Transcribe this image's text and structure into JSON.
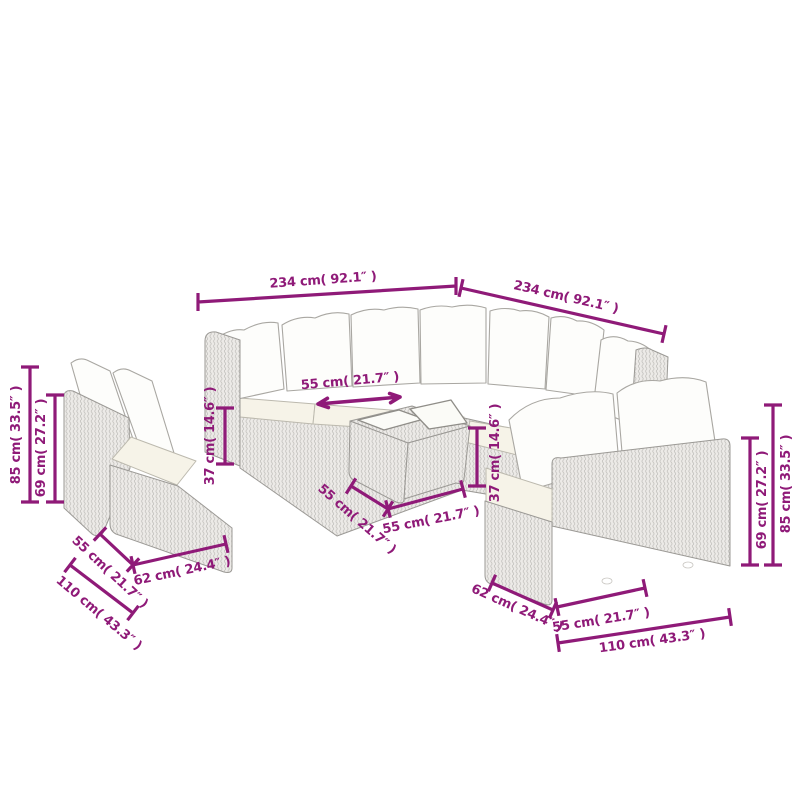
{
  "page": {
    "background": "#ffffff",
    "subject": "Modular poly-rattan garden lounge set (corner sofa, two 2-seater sofas, glass-top coffee table) shown as outline drawing with dimension lines"
  },
  "colors": {
    "dimension_line": "#8f1a78",
    "wicker_gray": "#e9e8e6",
    "cushion_white": "#fdfdfb",
    "seat_cream": "#f6f3e8"
  },
  "annotations": [
    {
      "id": "sofa-width-left",
      "label": "234 cm( 92.1″ )"
    },
    {
      "id": "sofa-width-right",
      "label": "234 cm( 92.1″ )"
    },
    {
      "id": "seat-width-top",
      "label": "55 cm( 21.7″ )"
    },
    {
      "id": "seat-height-left",
      "label": "37 cm( 14.6″ )"
    },
    {
      "id": "total-height-left",
      "label": "85 cm( 33.5″ )"
    },
    {
      "id": "back-height-left",
      "label": "69 cm( 27.2″ )"
    },
    {
      "id": "seat-depth-left",
      "label": "55 cm( 21.7″ )"
    },
    {
      "id": "module-width-left",
      "label": "62 cm( 24.4″ )"
    },
    {
      "id": "total-depth-left",
      "label": "110 cm( 43.3″ )"
    },
    {
      "id": "table-depth",
      "label": "55 cm( 21.7″ )"
    },
    {
      "id": "table-width",
      "label": "55 cm( 21.7″ )"
    },
    {
      "id": "table-height",
      "label": "37 cm( 14.6″ )"
    },
    {
      "id": "module-depth-right",
      "label": "62 cm( 24.4″ )"
    },
    {
      "id": "seat-width-right",
      "label": "55 cm( 21.7″ )"
    },
    {
      "id": "total-width-right",
      "label": "110 cm( 43.3″ )"
    },
    {
      "id": "back-height-right",
      "label": "69 cm( 27.2″ )"
    },
    {
      "id": "total-height-right",
      "label": "85 cm( 33.5″ )"
    }
  ]
}
